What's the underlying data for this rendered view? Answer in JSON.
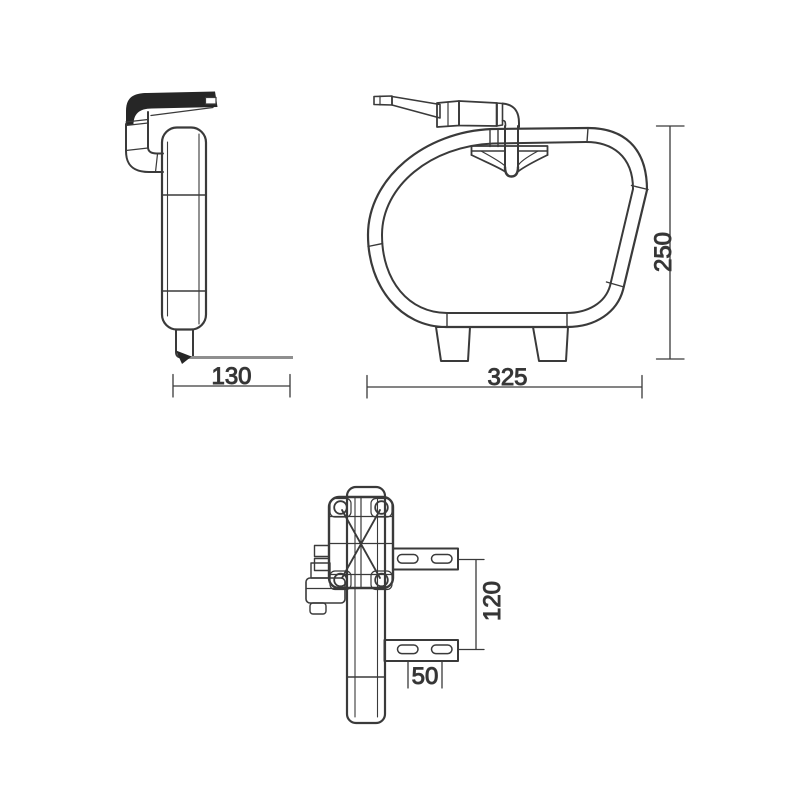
{
  "colors": {
    "line": "#3a3a3a",
    "dark": "#262626",
    "gray": "#8f8f8f",
    "text": "#333333",
    "background": "#ffffff"
  },
  "dimensions": {
    "side_width": "130",
    "front_width": "325",
    "front_height": "250",
    "back_bracket_spacing": "120",
    "back_slot_spacing": "50"
  }
}
